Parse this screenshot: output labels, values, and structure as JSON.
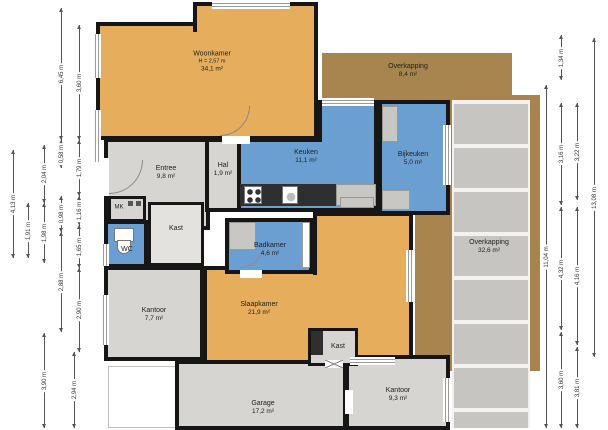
{
  "floorplan": {
    "type": "floor-plan",
    "rooms": {
      "woonkamer": {
        "name": "Woonkamer",
        "ceiling": "H = 2,57 m",
        "area": "34,1 m²"
      },
      "overkapping_top": {
        "name": "Overkapping",
        "area": "8,4 m²"
      },
      "entree": {
        "name": "Entree",
        "area": "9,8 m²"
      },
      "hal": {
        "name": "Hal",
        "area": "1,9 m²"
      },
      "keuken": {
        "name": "Keuken",
        "area": "11,1 m²"
      },
      "bijkeuken": {
        "name": "Bijkeuken",
        "area": "5,0 m²"
      },
      "meterkast": {
        "name": "MK"
      },
      "kast_hal": {
        "name": "Kast"
      },
      "wc": {
        "name": "WC"
      },
      "badkamer": {
        "name": "Badkamer",
        "area": "4,6 m²"
      },
      "kantoor_links": {
        "name": "Kantoor",
        "area": "7,7 m²"
      },
      "slaapkamer": {
        "name": "Slaapkamer",
        "area": "21,9 m²"
      },
      "kast_midden": {
        "name": "Kast"
      },
      "overkapping_rechts": {
        "name": "Overkapping",
        "area": "32,6 m²"
      },
      "garage": {
        "name": "Garage",
        "area": "17,2 m²"
      },
      "kantoor_rechts": {
        "name": "Kantoor",
        "area": "9,3 m²"
      }
    },
    "colors": {
      "room_orange": "#E6AD5C",
      "room_blue": "#6B9FD2",
      "room_gray": "#D6D5D1",
      "overkapping_brown": "#A8854F",
      "slat_gray": "#C7C5C1",
      "wall_black": "#161616"
    },
    "dimensions": {
      "unit": "m",
      "left": [
        {
          "v": "4,13 m",
          "x": 13,
          "y1": 150,
          "y2": 258
        },
        {
          "v": "1,91 m",
          "x": 28,
          "y1": 203,
          "y2": 258
        },
        {
          "v": "2,04 m",
          "x": 44,
          "y1": 145,
          "y2": 203
        },
        {
          "v": "1,98 m",
          "x": 44,
          "y1": 203,
          "y2": 263
        },
        {
          "v": "3,90 m",
          "x": 44,
          "y1": 333,
          "y2": 428
        },
        {
          "v": "6,45 m",
          "x": 61,
          "y1": 8,
          "y2": 140
        },
        {
          "v": "0,58 m",
          "x": 61,
          "y1": 140,
          "y2": 168
        },
        {
          "v": "0,98 m",
          "x": 61,
          "y1": 196,
          "y2": 232
        },
        {
          "v": "2,88 m",
          "x": 61,
          "y1": 232,
          "y2": 332
        },
        {
          "v": "2,94 m",
          "x": 74,
          "y1": 352,
          "y2": 428
        },
        {
          "v": "3,60 m",
          "x": 79,
          "y1": 25,
          "y2": 140
        },
        {
          "v": "1,79 m",
          "x": 79,
          "y1": 140,
          "y2": 196
        },
        {
          "v": "1,16 m",
          "x": 79,
          "y1": 196,
          "y2": 225
        },
        {
          "v": "1,65 m",
          "x": 79,
          "y1": 225,
          "y2": 268
        },
        {
          "v": "2,90 m",
          "x": 79,
          "y1": 268,
          "y2": 352
        }
      ],
      "right": [
        {
          "v": "11,04 m",
          "x": 546,
          "y1": 85,
          "y2": 428
        },
        {
          "v": "1,34 m",
          "x": 561,
          "y1": 35,
          "y2": 80
        },
        {
          "v": "3,16 m",
          "x": 561,
          "y1": 103,
          "y2": 205
        },
        {
          "v": "4,32 m",
          "x": 561,
          "y1": 207,
          "y2": 330
        },
        {
          "v": "3,60 m",
          "x": 561,
          "y1": 332,
          "y2": 428
        },
        {
          "v": "3,22 m",
          "x": 577,
          "y1": 103,
          "y2": 200
        },
        {
          "v": "4,16 m",
          "x": 577,
          "y1": 207,
          "y2": 345
        },
        {
          "v": "3,81 m",
          "x": 577,
          "y1": 347,
          "y2": 428
        },
        {
          "v": "13,08 m",
          "x": 594,
          "y1": 38,
          "y2": 357
        }
      ]
    }
  }
}
